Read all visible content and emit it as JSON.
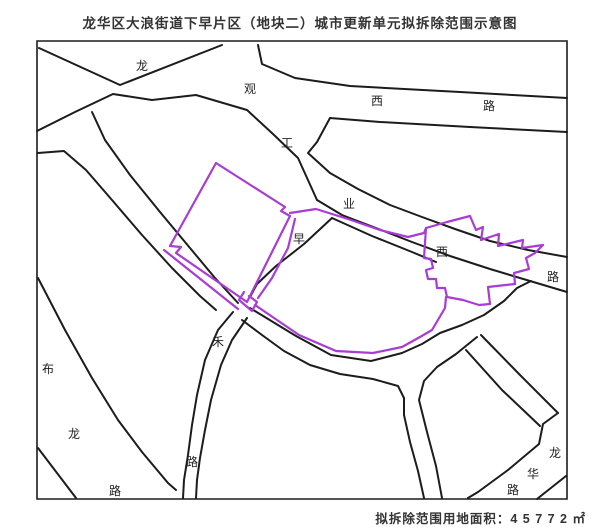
{
  "title": "龙华区大浪街道下早片区（地块二）城市更新单元拟拆除范围示意图",
  "caption": {
    "label": "拟拆除范围用地面积：",
    "value": "4 5 7 7 2",
    "unit": "㎡",
    "full_text": "拟拆除范围用地面积：4 5 7 7 2 ㎡",
    "area_sqm": 45772
  },
  "colors": {
    "boundary": "#a93cd4",
    "road": "#1c1c1c",
    "label_text": "#222222"
  },
  "map": {
    "boundary_name": "拟拆除范围",
    "road_labels": [
      {
        "name": "龙观西路",
        "chars": [
          {
            "c": "龙",
            "x": 142,
            "y": 66
          },
          {
            "c": "观",
            "x": 250,
            "y": 89
          },
          {
            "c": "西",
            "x": 377,
            "y": 101
          },
          {
            "c": "路",
            "x": 489,
            "y": 106
          }
        ]
      },
      {
        "name": "工业西路",
        "chars": [
          {
            "c": "工",
            "x": 287,
            "y": 143
          },
          {
            "c": "业",
            "x": 349,
            "y": 204
          },
          {
            "c": "西",
            "x": 442,
            "y": 252
          },
          {
            "c": "路",
            "x": 553,
            "y": 277
          }
        ]
      },
      {
        "name": "早禾路",
        "chars": [
          {
            "c": "早",
            "x": 299,
            "y": 239
          },
          {
            "c": "禾",
            "x": 218,
            "y": 342
          },
          {
            "c": "路",
            "x": 192,
            "y": 462
          }
        ]
      },
      {
        "name": "布龙路",
        "chars": [
          {
            "c": "布",
            "x": 48,
            "y": 369
          },
          {
            "c": "龙",
            "x": 74,
            "y": 434
          },
          {
            "c": "路",
            "x": 115,
            "y": 491
          }
        ]
      },
      {
        "name": "龙华路",
        "chars": [
          {
            "c": "龙",
            "x": 555,
            "y": 453
          },
          {
            "c": "华",
            "x": 533,
            "y": 474
          },
          {
            "c": "路",
            "x": 513,
            "y": 490
          }
        ]
      }
    ]
  }
}
